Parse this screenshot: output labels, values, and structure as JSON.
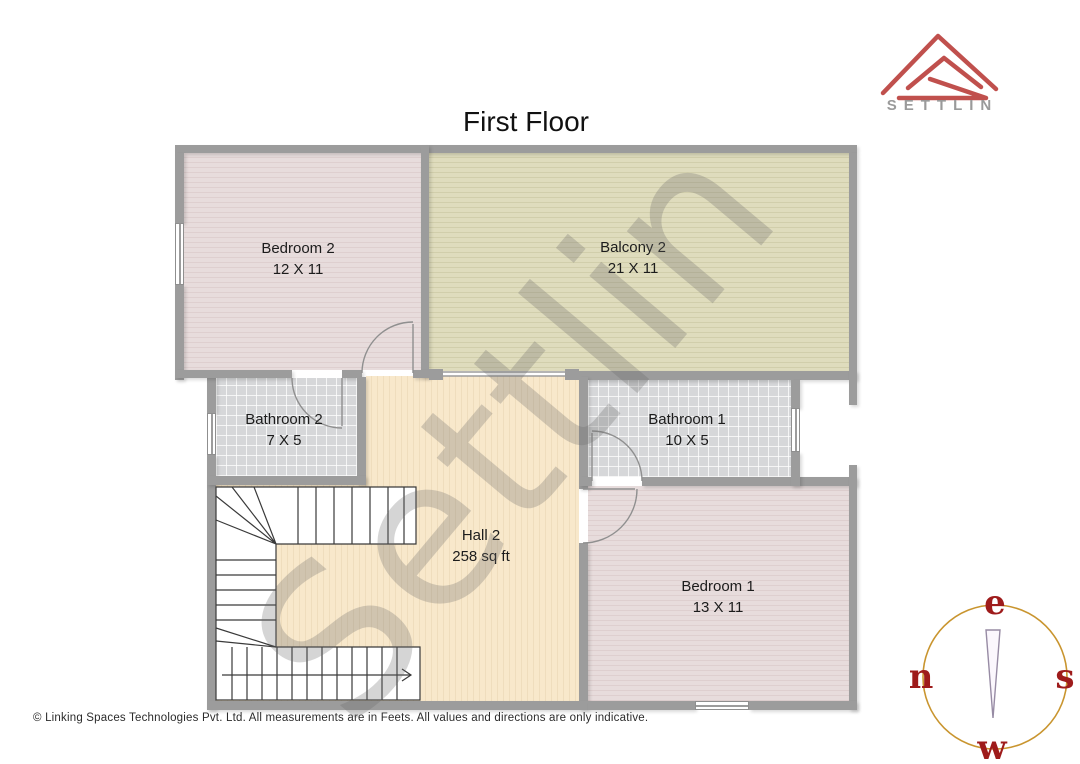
{
  "title": "First Floor",
  "brand": {
    "name": "SETTLIN"
  },
  "watermark": "Settlin",
  "rooms": {
    "bedroom2": {
      "name": "Bedroom 2",
      "dims": "12 X 11"
    },
    "balcony2": {
      "name": "Balcony 2",
      "dims": "21 X 11"
    },
    "bathroom2": {
      "name": "Bathroom 2",
      "dims": "7 X 5"
    },
    "bathroom1": {
      "name": "Bathroom 1",
      "dims": "10 X 5"
    },
    "hall2": {
      "name": "Hall 2",
      "dims": "258 sq ft"
    },
    "bedroom1": {
      "name": "Bedroom 1",
      "dims": "13 X 11"
    }
  },
  "compass": {
    "top": "e",
    "left": "n",
    "right": "s",
    "bottom": "w"
  },
  "footer": {
    "copyright": "© Linking Spaces Technologies Pvt. Ltd. All measurements are in Feets. All values and directions are only indicative."
  },
  "colors": {
    "wall": "#9c9c9c",
    "logo_red": "#c0504d",
    "brand_text": "#9a9a9a",
    "compass_ring": "#c9952f",
    "compass_letters": "#9e1b1b",
    "bedroom_floor": "#e6dada",
    "balcony_floor": "#dedbbc",
    "bathroom_floor": "#d6d7d9",
    "hall_floor": "#f7e6c9"
  }
}
